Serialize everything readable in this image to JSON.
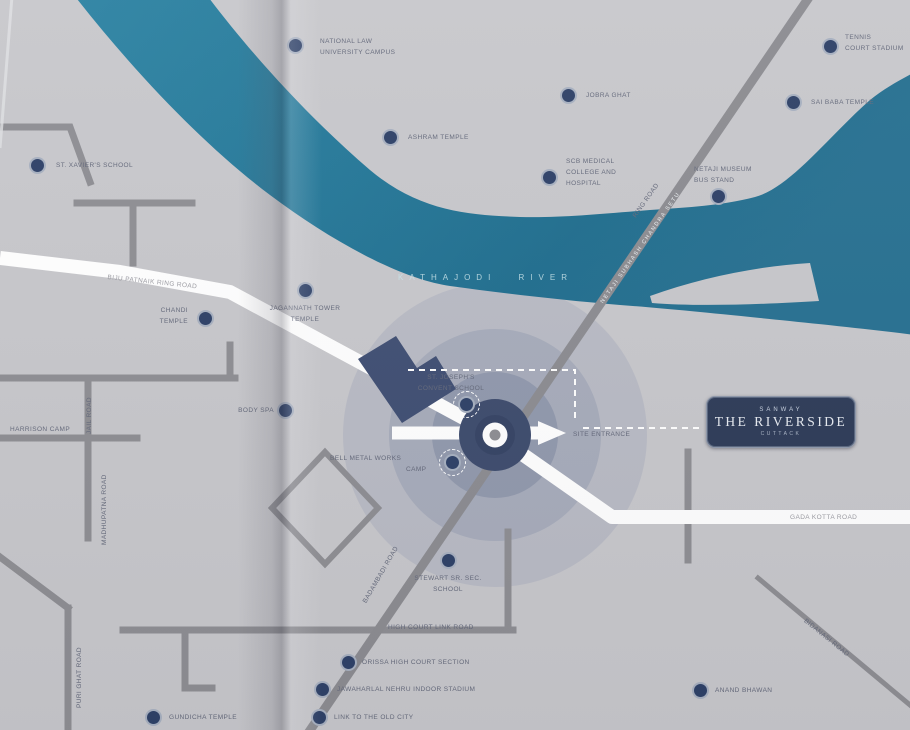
{
  "map": {
    "type": "brochure-location-map",
    "river_name": "KATHAJODI RIVER",
    "colors": {
      "land": "#c7c7cb",
      "river": "#2a7e9e",
      "river_deep": "#1d6788",
      "road_gray": "#8d8d92",
      "road_white": "#ffffff",
      "marker_navy": "#2c3f66",
      "site_core_navy": "#3c4a6c",
      "badge_navy": "#2c3a57"
    }
  },
  "project_box": {
    "brand": "SANWAY",
    "name": "THE RIVERSIDE",
    "location": "CUTTACK"
  },
  "site": {
    "entrance_label": "SITE ENTRANCE",
    "rings_icon": "radius-rings",
    "roundabout_icon": "roundabout"
  },
  "roads": [
    {
      "id": "ring-road-left",
      "label": "BIJU PATNAIK RING ROAD"
    },
    {
      "id": "kotta-road",
      "label": "GADA KOTTA ROAD"
    },
    {
      "id": "high-court-link",
      "label": "HIGH COURT LINK ROAD"
    },
    {
      "id": "ring-road-upper",
      "label": "RING ROAD"
    },
    {
      "id": "bridge",
      "label": "NETAJI SUBHASH CHANDRA SETU"
    },
    {
      "id": "badambadi-road",
      "label": "BADAMBADI ROAD"
    },
    {
      "id": "jail-road",
      "label": "JAIL ROAD"
    },
    {
      "id": "madhupatna-road",
      "label": "MADHUPATNA ROAD"
    },
    {
      "id": "puri-ghat-road",
      "label": "PURI GHAT ROAD"
    },
    {
      "id": "bidanasi-road",
      "label": "BIDANASI ROAD"
    }
  ],
  "places": [
    {
      "id": "harrison-camp",
      "label": "HARRISON CAMP"
    }
  ],
  "pois": [
    {
      "id": "st-xaviers",
      "lines": [
        "ST. XAVIER'S SCHOOL"
      ]
    },
    {
      "id": "law-university",
      "lines": [
        "NATIONAL LAW",
        "UNIVERSITY CAMPUS"
      ]
    },
    {
      "id": "ashram-temple",
      "lines": [
        "ASHRAM TEMPLE"
      ]
    },
    {
      "id": "jobra-ghat",
      "lines": [
        "JOBRA GHAT"
      ]
    },
    {
      "id": "scb-medical",
      "lines": [
        "SCB MEDICAL",
        "COLLEGE AND",
        "HOSPITAL"
      ]
    },
    {
      "id": "tennis-stadium",
      "lines": [
        "TENNIS",
        "COURT STADIUM"
      ]
    },
    {
      "id": "sai-baba-temple",
      "lines": [
        "SAI BABA TEMPLE"
      ]
    },
    {
      "id": "netaji-museum",
      "lines": [
        "NETAJI MUSEUM",
        "BUS STAND"
      ]
    },
    {
      "id": "chandi-temple",
      "lines": [
        "CHANDI",
        "TEMPLE"
      ]
    },
    {
      "id": "jagannath-tower",
      "lines": [
        "JAGANNATH TOWER",
        "TEMPLE"
      ]
    },
    {
      "id": "body-spa",
      "lines": [
        "BODY SPA"
      ]
    },
    {
      "id": "st-josephs",
      "lines": [
        "ST. JOSEPH'S",
        "CONVENT SCHOOL"
      ]
    },
    {
      "id": "bell-metal",
      "lines": [
        "BELL METAL WORKS",
        "CAMP"
      ]
    },
    {
      "id": "stewart-school",
      "lines": [
        "STEWART SR. SEC.",
        "SCHOOL"
      ]
    },
    {
      "id": "high-court",
      "lines": [
        "ORISSA HIGH COURT SECTION"
      ]
    },
    {
      "id": "indoor-stadium",
      "lines": [
        "JAWAHARLAL NEHRU INDOOR STADIUM"
      ]
    },
    {
      "id": "old-city-link",
      "lines": [
        "LINK TO THE OLD CITY"
      ]
    },
    {
      "id": "gundicha-temple",
      "lines": [
        "GUNDICHA TEMPLE"
      ]
    },
    {
      "id": "anand-bhawan",
      "lines": [
        "ANAND BHAWAN"
      ]
    }
  ]
}
